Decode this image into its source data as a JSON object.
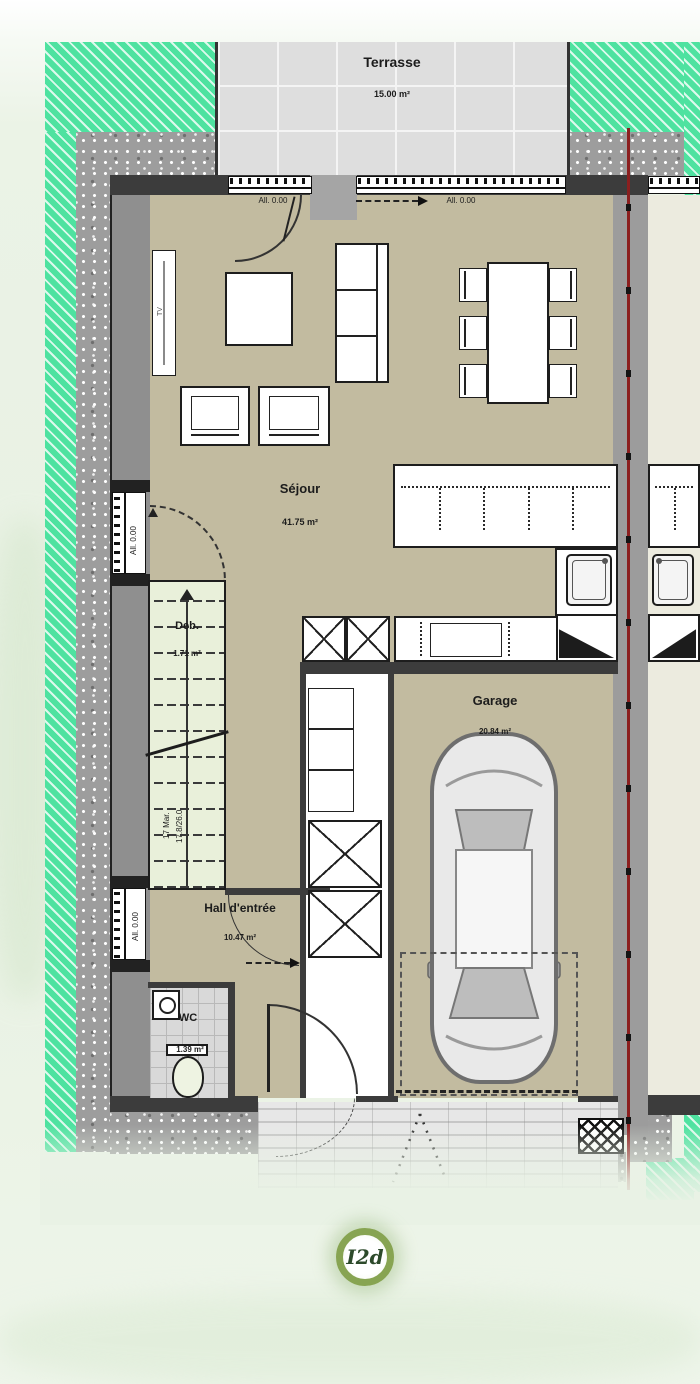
{
  "plan_title": "Rez-de-chaussée floor plan",
  "rooms": {
    "terrasse": {
      "name": "Terrasse",
      "area": "15.00 m²"
    },
    "sejour": {
      "name": "Séjour",
      "area": "41.75 m²"
    },
    "deb": {
      "name": "Deb.",
      "area": "1.71 m²"
    },
    "garage": {
      "name": "Garage",
      "area": "20.84 m²"
    },
    "hall": {
      "name": "Hall d'entrée",
      "area": "10.47 m²"
    },
    "wc": {
      "name": "WC",
      "area": "1.39 m²"
    }
  },
  "annotations": {
    "sill_top_left": "All. 0.00",
    "sill_top_right": "All. 0.00",
    "sill_left_upper": "All. 0.00",
    "sill_left_lower": "All. 0.00",
    "tv_label": "TV",
    "stair_count": "17 Mar.",
    "stair_dimensions": "17.8/26.0"
  },
  "badge": {
    "label": "I2d"
  },
  "colors": {
    "floor_beige": "#c2bba0",
    "lawn_green": "#4ee2a0",
    "terrace_gray": "#dedede",
    "wall_dark": "#3c3c3c",
    "wall_mid": "#8f8f8f",
    "stair_green": "#e9f0da",
    "boundary_red": "#8b1f1f",
    "badge_ring_green": "#87a452",
    "background_wash": "#e8f1e3"
  }
}
